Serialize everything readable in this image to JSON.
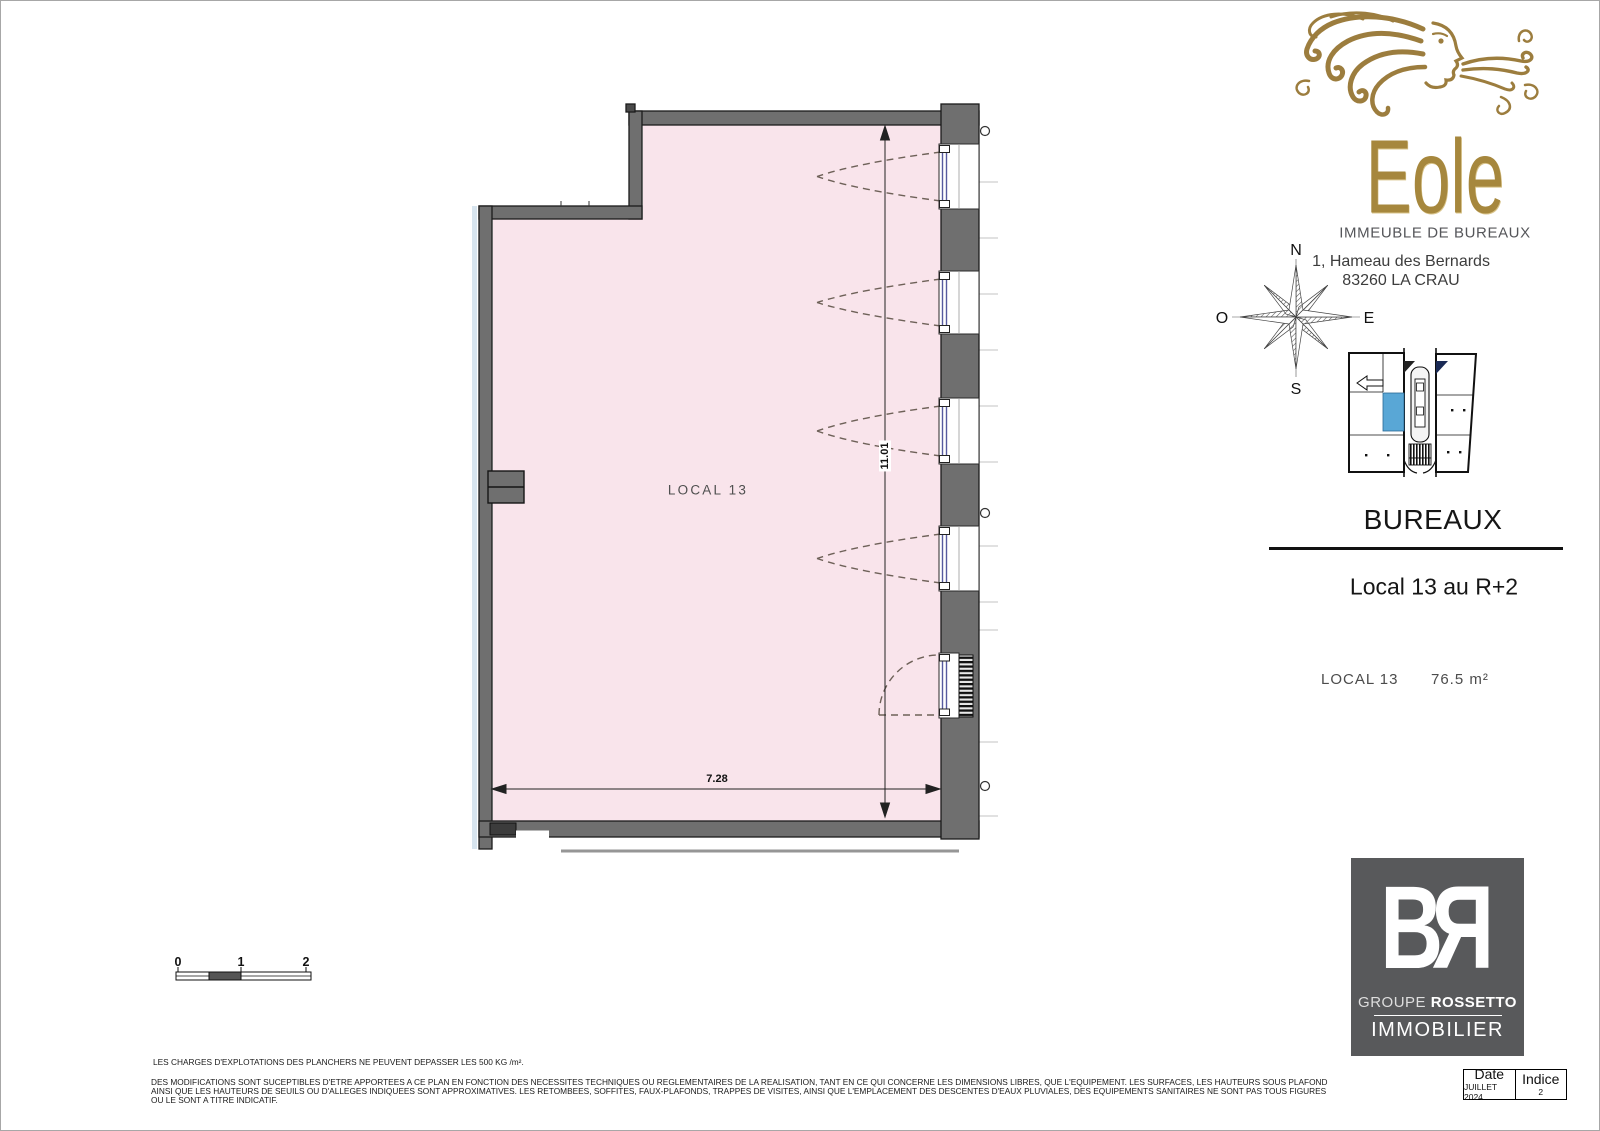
{
  "brand": {
    "name": "Eole",
    "type_label": "IMMEUBLE DE BUREAUX",
    "address_line1": "1, Hameau des Bernards",
    "address_line2": "83260 LA CRAU"
  },
  "compass": {
    "north": "N",
    "west": "O",
    "east": "E",
    "south": "S"
  },
  "panel": {
    "category_title": "BUREAUX",
    "unit_title": "Local 13 au R+2",
    "unit_name": "LOCAL 13",
    "unit_area": "76.5 m²"
  },
  "plan": {
    "room_label": "LOCAL 13",
    "dim_width": "7.28",
    "dim_height": "11.01",
    "scale_labels": [
      "0",
      "1",
      "2"
    ]
  },
  "legal": {
    "charges_note": "LES CHARGES D'EXPLOTATIONS DES PLANCHERS NE PEUVENT DEPASSER LES 500 KG /m².",
    "modifications_line1": "DES MODIFICATIONS SONT SUCEPTIBLES D'ETRE APPORTEES A CE PLAN EN FONCTION DES NECESSITES TECHNIQUES OU REGLEMENTAIRES DE LA REALISATION, TANT EN CE QUI CONCERNE LES DIMENSIONS LIBRES, QUE L'EQUIPEMENT. LES SURFACES, LES HAUTEURS SOUS PLAFOND",
    "modifications_line2": "AINSI QUE LES HAUTEURS DE SEUILS OU D'ALLEGES INDIQUEES SONT APPROXIMATIVES. LES RETOMBEES, SOFFITES, FAUX-PLAFONDS, TRAPPES DE VISITES, AINSI QUE L'EMPLACEMENT DES DESCENTES D'EAUX PLUVIALES, DES EQUIPEMENTS SANITAIRES NE SONT PAS TOUS FIGURES",
    "modifications_line3": "OU LE SONT A TITRE INDICATIF."
  },
  "revision": {
    "date_label": "Date",
    "date_value": "JUILLET 2024",
    "indice_label": "Indice",
    "indice_value": "2"
  },
  "br_logo": {
    "letter_b": "B",
    "letter_r": "R",
    "groupe": "GROUPE",
    "rossetto": "ROSSETTO",
    "immobilier": "IMMOBILIER"
  },
  "colors": {
    "room_fill": "#f9e4eb",
    "wall": "#6f6f6f",
    "glazing": "#565a9e",
    "gold": "#a6873d",
    "locator_highlight": "#59a7d6",
    "logo_bg": "#58595b"
  }
}
